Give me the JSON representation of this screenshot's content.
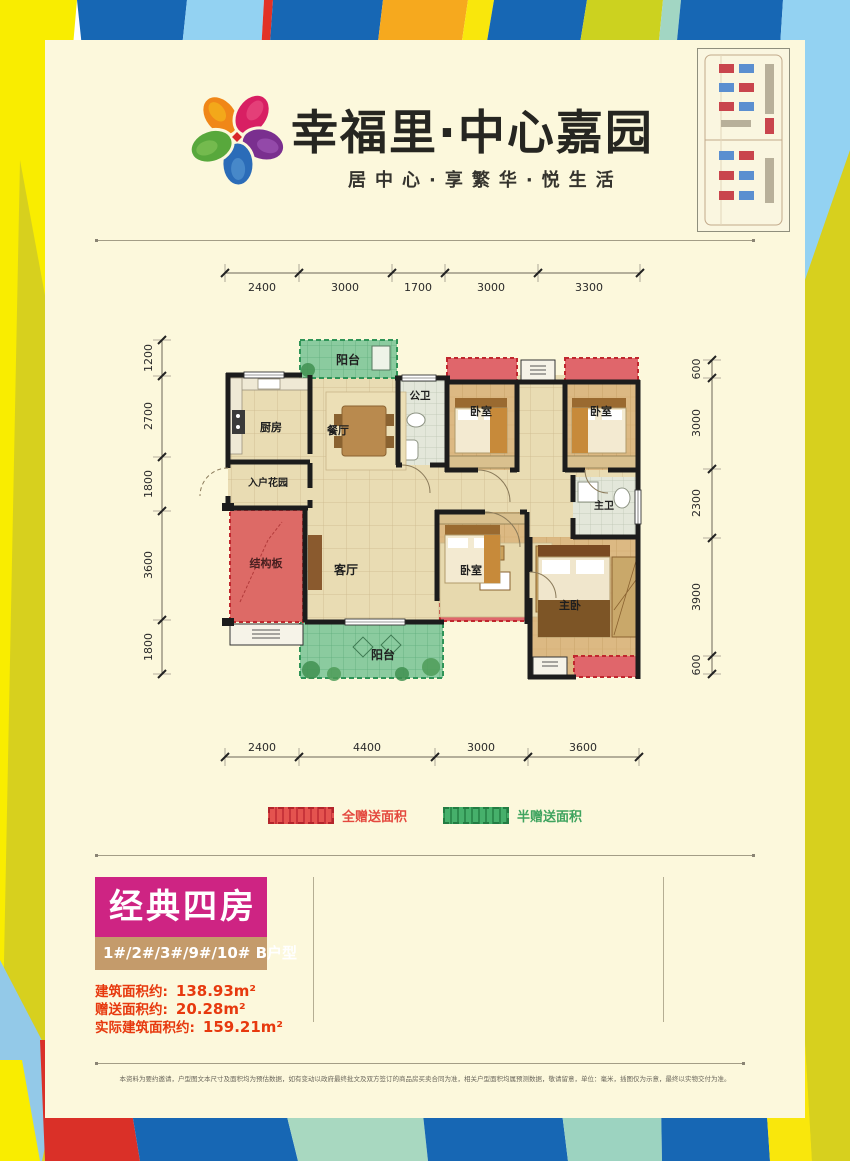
{
  "brand": {
    "name": "幸福里·中心嘉园",
    "slogan": "居中心·享繁华·悦生活"
  },
  "plan": {
    "rooms": {
      "balcony": "阳台",
      "public_bath": "公卫",
      "bedroom": "卧室",
      "kitchen": "厨房",
      "dining": "餐厅",
      "entry_garden": "入户花园",
      "structural_slab": "结构板",
      "living": "客厅",
      "master_bath": "主卫",
      "master_bedroom": "主卧"
    },
    "dims_top": [
      "2400",
      "3000",
      "1700",
      "3000",
      "3300"
    ],
    "dims_bottom": [
      "2400",
      "4400",
      "3000",
      "3600"
    ],
    "dims_left": [
      "1200",
      "2700",
      "1800",
      "3600",
      "1800"
    ],
    "dims_right": [
      "600",
      "3000",
      "2300",
      "3900",
      "600"
    ]
  },
  "legend": {
    "full": "全赠送面积",
    "half": "半赠送面积"
  },
  "info": {
    "title": "经典四房",
    "units": "1#/2#/3#/9#/10#  B户型",
    "areas": [
      {
        "label": "建筑面积约:",
        "value": "138.93m²"
      },
      {
        "label": "赠送面积约:",
        "value": "20.28m²"
      },
      {
        "label": "实际建筑面积约:",
        "value": "159.21m²"
      }
    ]
  },
  "footer": {
    "disclaimer": "本资料为要约邀请，户型图文本尺寸及面积均为预估数据，如有变动以政府最终批文及双方签订的商品房买卖合同为准，相关户型面积均属预测数据，敬请留意，单位：毫米，插图仅为示意，最终以实物交付为准。"
  },
  "colors": {
    "accent_pink": "#ce2483",
    "unit_tan": "#c49b6b",
    "full_gift_red": "#e0666b",
    "half_gift_green": "#8fcda4",
    "area_text_red": "#e7390e",
    "border_blue": "#1767b4",
    "border_yellow": "#f9ed00"
  }
}
